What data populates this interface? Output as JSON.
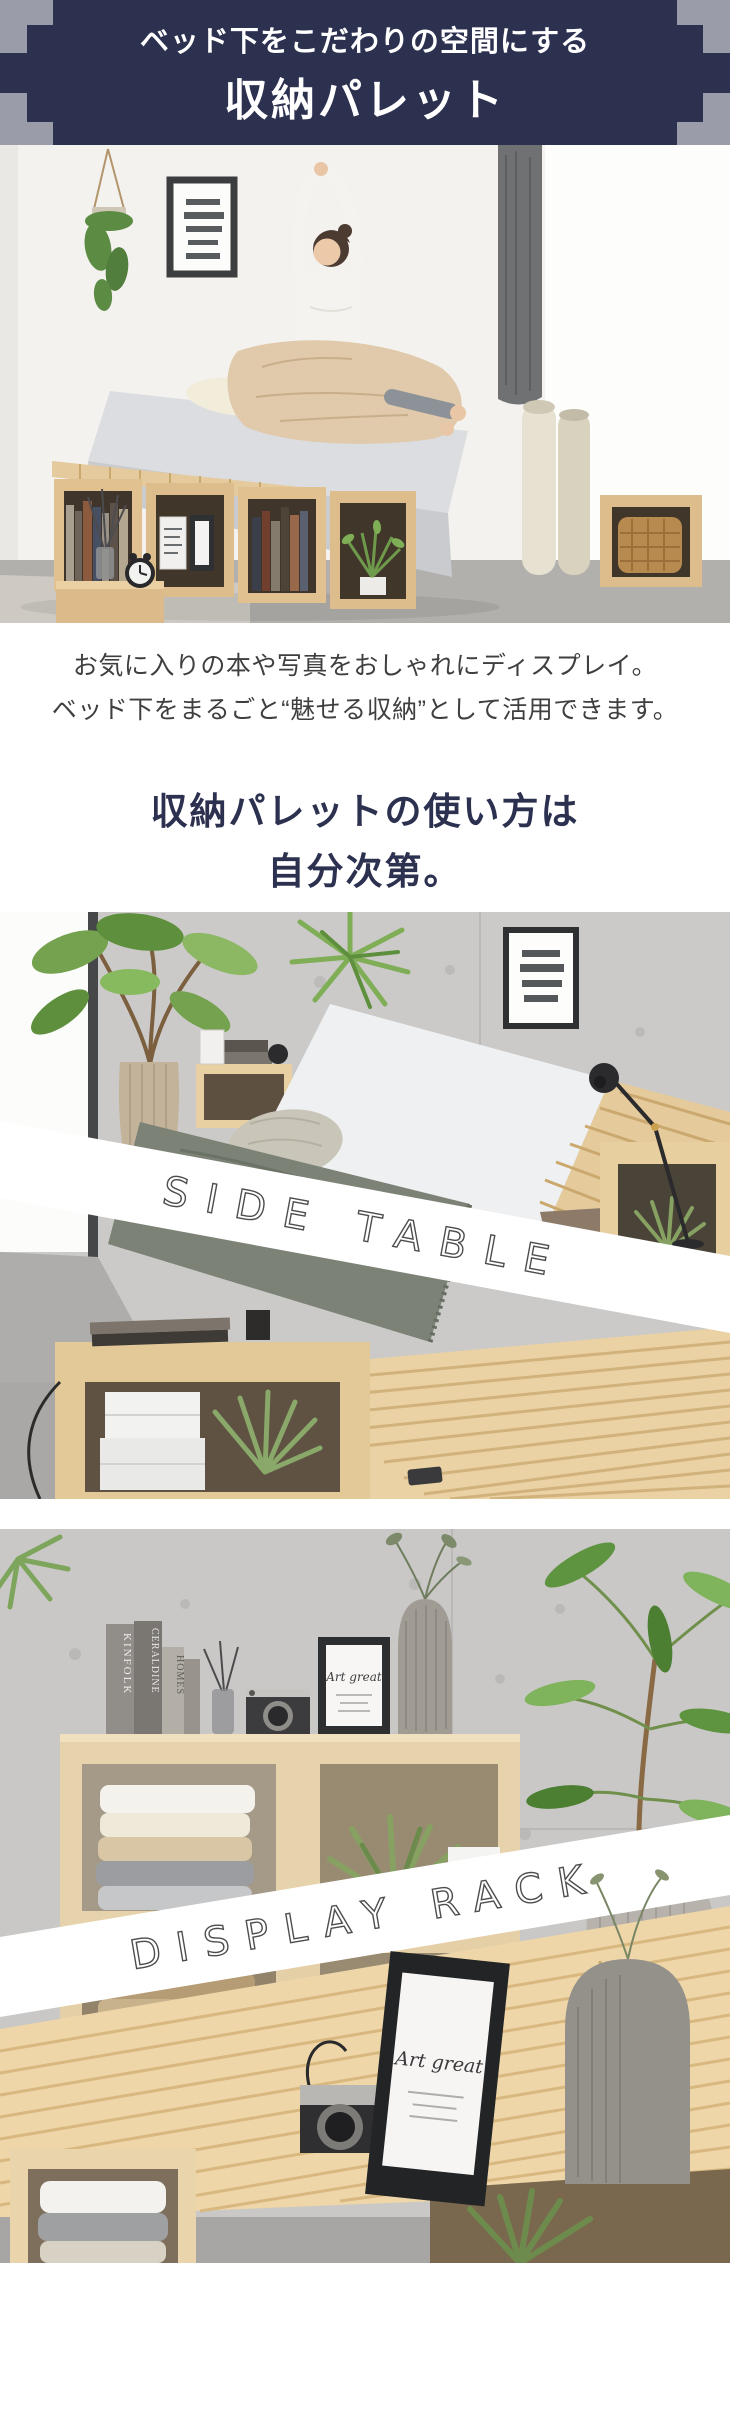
{
  "colors": {
    "navy": "#2d3150",
    "page_gray": "#9a9ca9",
    "text_dark": "#3f3f3f",
    "band_background": "#ffffff",
    "band_outline": "#4d4d4d",
    "header_text": "#ffffff"
  },
  "header": {
    "subtitle": "ベッド下をこだわりの空間にする",
    "title": "収納パレット"
  },
  "intro": {
    "line1": "お気に入りの本や写真をおしゃれにディスプレイ。",
    "line2": "ベッド下をまるごと“魅せる収納”として活用できます。"
  },
  "usage_heading": {
    "line1": "収納パレットの使い方は",
    "line2": "自分次第。"
  },
  "photo_side_table": {
    "band_label": "SIDE TABLE"
  },
  "photo_display_rack": {
    "band_label": "DISPLAY RACK",
    "books": [
      "KINFOLK",
      "CERALDINE",
      "HOMES"
    ],
    "frame_text": "Art great"
  }
}
